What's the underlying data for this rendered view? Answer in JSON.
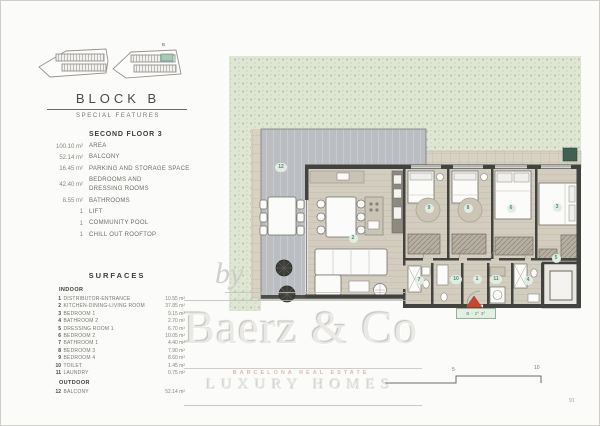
{
  "header": {
    "block_title": "BLOCK B",
    "subtitle": "SPECIAL FEATURES"
  },
  "site_icons": {
    "block_label": "B"
  },
  "floor_summary": {
    "title": "SECOND FLOOR 3",
    "items": [
      {
        "value": "100.10 m²",
        "label": "AREA"
      },
      {
        "value": "52.14 m²",
        "label": "BALCONY"
      },
      {
        "value": "16.45 m²",
        "label": "PARKING AND STORAGE SPACE"
      },
      {
        "value": "42.40 m²",
        "label": "BEDROOMS AND\nDRESSING ROOMS"
      },
      {
        "value": "8.55 m²",
        "label": "BATHROOMS"
      },
      {
        "value": "1",
        "label": "LIFT"
      },
      {
        "value": "1",
        "label": "COMMUNITY POOL"
      },
      {
        "value": "1",
        "label": "CHILL OUT ROOFTOP"
      }
    ]
  },
  "surfaces": {
    "title": "SURFACES",
    "indoor_label": "INDOOR",
    "outdoor_label": "OUTDOOR",
    "indoor": [
      {
        "num": "1",
        "label": "DISTRIBUTOR-ENTRANCE",
        "value": "10.55 m²"
      },
      {
        "num": "2",
        "label": "KITCHEN-DINING-LIVING ROOM",
        "value": "37.85 m²"
      },
      {
        "num": "3",
        "label": "BEDROOM 1",
        "value": "9.15 m²"
      },
      {
        "num": "4",
        "label": "BATHROOM 2",
        "value": "2.70 m²"
      },
      {
        "num": "5",
        "label": "DRESSING ROOM 1",
        "value": "6.70 m²"
      },
      {
        "num": "6",
        "label": "BEDROOM 2",
        "value": "10.05 m²"
      },
      {
        "num": "7",
        "label": "BATHROOM 1",
        "value": "4.40 m²"
      },
      {
        "num": "8",
        "label": "BEDROOM 3",
        "value": "7.90 m²"
      },
      {
        "num": "9",
        "label": "BEDROOM 4",
        "value": "8.60 m²"
      },
      {
        "num": "10",
        "label": "TOILET",
        "value": "1.45 m²"
      },
      {
        "num": "11",
        "label": "LAUNDRY",
        "value": "0.75 m²"
      }
    ],
    "outdoor": [
      {
        "num": "12",
        "label": "BALCONY",
        "value": "52.14 m²"
      }
    ]
  },
  "plan": {
    "markers": [
      "1",
      "2",
      "3",
      "4",
      "5",
      "6",
      "7",
      "8",
      "9",
      "10",
      "11",
      "12"
    ],
    "unit_tag": "B - 2º 3º",
    "scale_labels": [
      "5",
      "10"
    ],
    "colors": {
      "landscape": "#dfe7d4",
      "terrace": "#babec2",
      "floor": "#d2cdbf",
      "wall": "#42423f",
      "marker_bg": "#e2ede2",
      "marker_text": "#4e8a77",
      "entrance_arrow": "#c7472e"
    }
  },
  "watermark": {
    "by": "by",
    "brand": "Baerz & Co",
    "tagline": "BARCELONA REAL ESTATE",
    "slogan": "LUXURY HOMES"
  },
  "footer": {
    "page_number": "91"
  }
}
